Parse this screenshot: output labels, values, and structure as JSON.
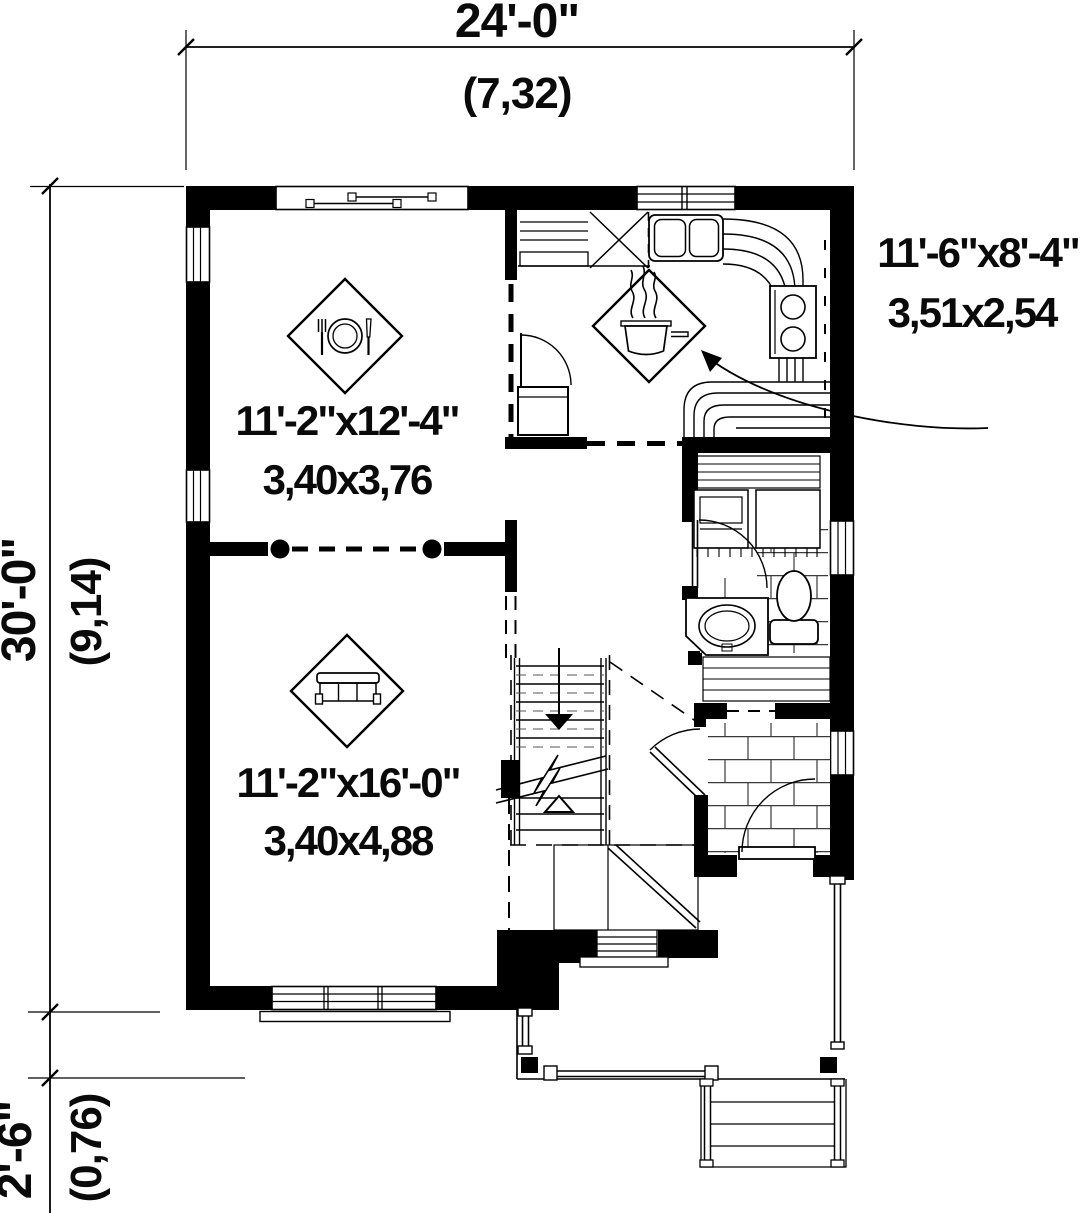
{
  "title": "Single family house first floor plan",
  "dimensions": {
    "overall_width": {
      "imperial": "24'-0\"",
      "metric": "(7,32)"
    },
    "overall_depth": {
      "imperial": "30'-0\"",
      "metric": "(9,14)"
    },
    "porch_depth": {
      "imperial": "2'-6\"",
      "metric": "(0,76)"
    }
  },
  "rooms": {
    "dining_room": {
      "size_imperial": "11'-2\"x12'-4\"",
      "size_metric": "3,40x3,76",
      "icon": "place-setting-icon"
    },
    "living_room": {
      "size_imperial": "11'-2\"x16'-0\"",
      "size_metric": "3,40x4,88",
      "icon": "sofa-icon"
    },
    "kitchen": {
      "size_imperial": "11'-6\"x8'-4\"",
      "size_metric": "3,51x2,54",
      "icon": "cooking-pot-icon"
    }
  },
  "colors": {
    "line": "#000000",
    "background": "#ffffff"
  }
}
